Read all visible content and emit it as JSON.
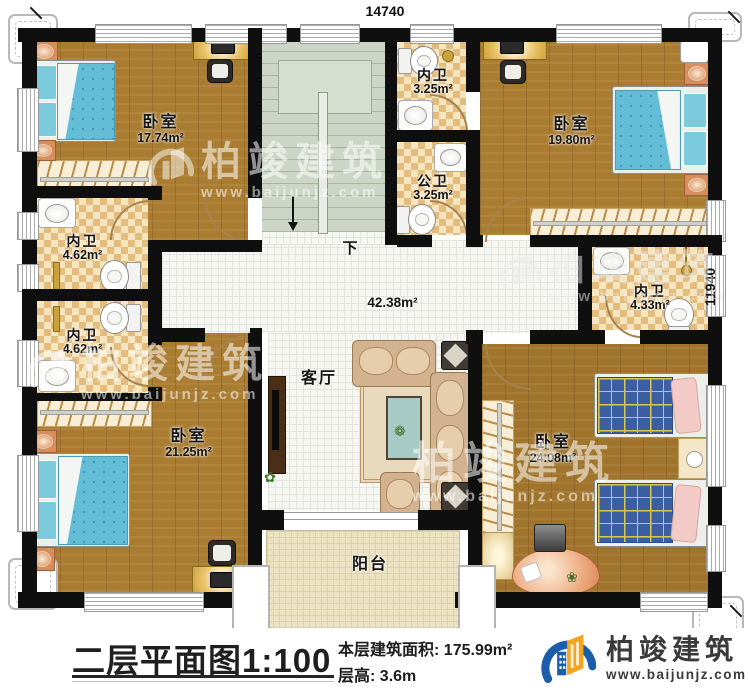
{
  "dimensions": {
    "top_width": "14740",
    "right_height": "11940"
  },
  "rooms": {
    "bedroom_tl": {
      "name": "卧室",
      "area": "17.74m²"
    },
    "bedroom_tr": {
      "name": "卧室",
      "area": "19.80m²"
    },
    "bedroom_bl": {
      "name": "卧室",
      "area": "21.25m²"
    },
    "bedroom_br": {
      "name": "卧室",
      "area": "24.08m²"
    },
    "bath_inner_top": {
      "name": "内卫",
      "area": "3.25m²"
    },
    "bath_public": {
      "name": "公卫",
      "area": "3.25m²"
    },
    "bath_inner_left_upper": {
      "name": "内卫",
      "area": "4.62m²"
    },
    "bath_inner_left_lower": {
      "name": "内卫",
      "area": "4.62m²"
    },
    "bath_inner_right": {
      "name": "内卫",
      "area": "4.33m²"
    },
    "hall": {
      "area": "42.38m²"
    },
    "living_room": {
      "name": "客厅"
    },
    "balcony": {
      "name": "阳台"
    },
    "stairs": {
      "down_label": "下"
    }
  },
  "caption": {
    "plan_title": "二层平面图",
    "plan_scale": "1:100",
    "floor_area_label": "本层建筑面积:",
    "floor_area_value": "175.99m²",
    "floor_height_label": "层高:",
    "floor_height_value": "3.6m"
  },
  "brand": {
    "company": "柏竣建筑",
    "website": "www.baijunjz.com"
  },
  "watermark": {
    "text": "柏竣建筑",
    "url": "www.baijunjz.com"
  },
  "colors": {
    "wall": "#0f0f0f",
    "wood_floor": "#a97c31",
    "hall_tile": "#f6f6f3",
    "bath_checker": "#e3bc7e",
    "stairs": "#ccd5c6",
    "balcony": "#ebe3c4",
    "bed_blue": "#63bdd7",
    "plaid_blue": "#3c5fa2",
    "brand_blue": "#1a5dab",
    "brand_orange": "#f6a41d"
  }
}
